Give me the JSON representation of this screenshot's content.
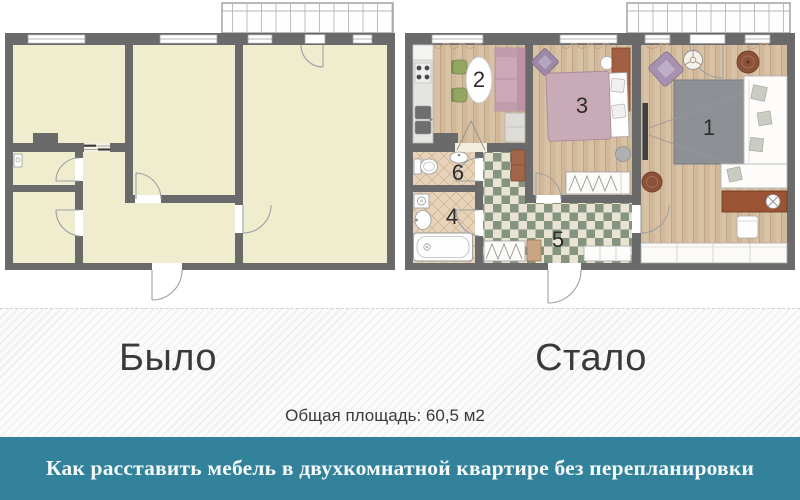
{
  "captions": {
    "before_label": "Было",
    "after_label": "Стало",
    "area_text": "Общая площадь: 60,5 м2"
  },
  "banner": {
    "title": "Как расставить мебель в двухкомнатной квартире без перепланировки",
    "background_color": "#32829b",
    "text_color": "#f5f9fa"
  },
  "plan_after": {
    "room_numbers": {
      "living_room": "1",
      "kitchen": "2",
      "bedroom": "3",
      "bathroom": "4",
      "hallway": "5",
      "toilet": "6"
    }
  },
  "palette": {
    "wall": "#6a6a6a",
    "empty_room_fill": "#f0ecce",
    "wood_floor": "#d8c2a6",
    "checker_dark": "#85947f",
    "checker_light": "#e9e3d4",
    "tile_floor": "#e7d3b9",
    "divider_dashed": "#d2d2d2",
    "background_stripe": "#efefef"
  }
}
